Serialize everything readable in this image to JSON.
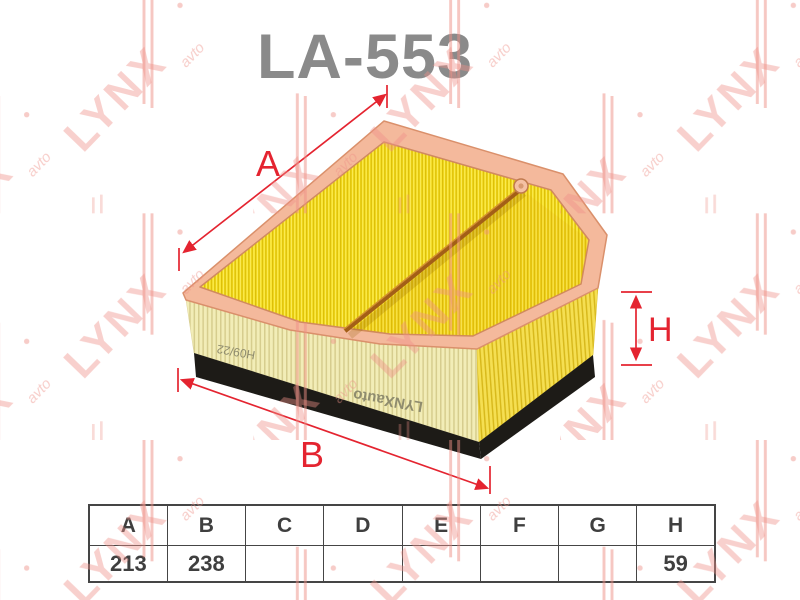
{
  "title": "LA-553",
  "watermark": {
    "brand": "LYNX",
    "suffix": "avto"
  },
  "diagram": {
    "dim_labels": {
      "a": "A",
      "b": "B",
      "h": "H"
    },
    "side_markings": {
      "brand": "LYNXauto",
      "code": "H09/22"
    }
  },
  "spec_table": {
    "headers": [
      "A",
      "B",
      "C",
      "D",
      "E",
      "F",
      "G",
      "H"
    ],
    "values": [
      "213",
      "238",
      "",
      "",
      "",
      "",
      "",
      "59"
    ]
  },
  "colors": {
    "dimension_red": "#e42430",
    "title_gray": "#8a8a8a",
    "frame_salmon": "#f4b99c",
    "media_yellow_top": "#f8e123",
    "media_cream_side": "#f2edb7",
    "media_yellow_side": "#f5df52",
    "base_black": "#1d1b17",
    "watermark_pink": "#ee8f86",
    "table_line": "#454545",
    "table_text": "#3f3f3f"
  }
}
